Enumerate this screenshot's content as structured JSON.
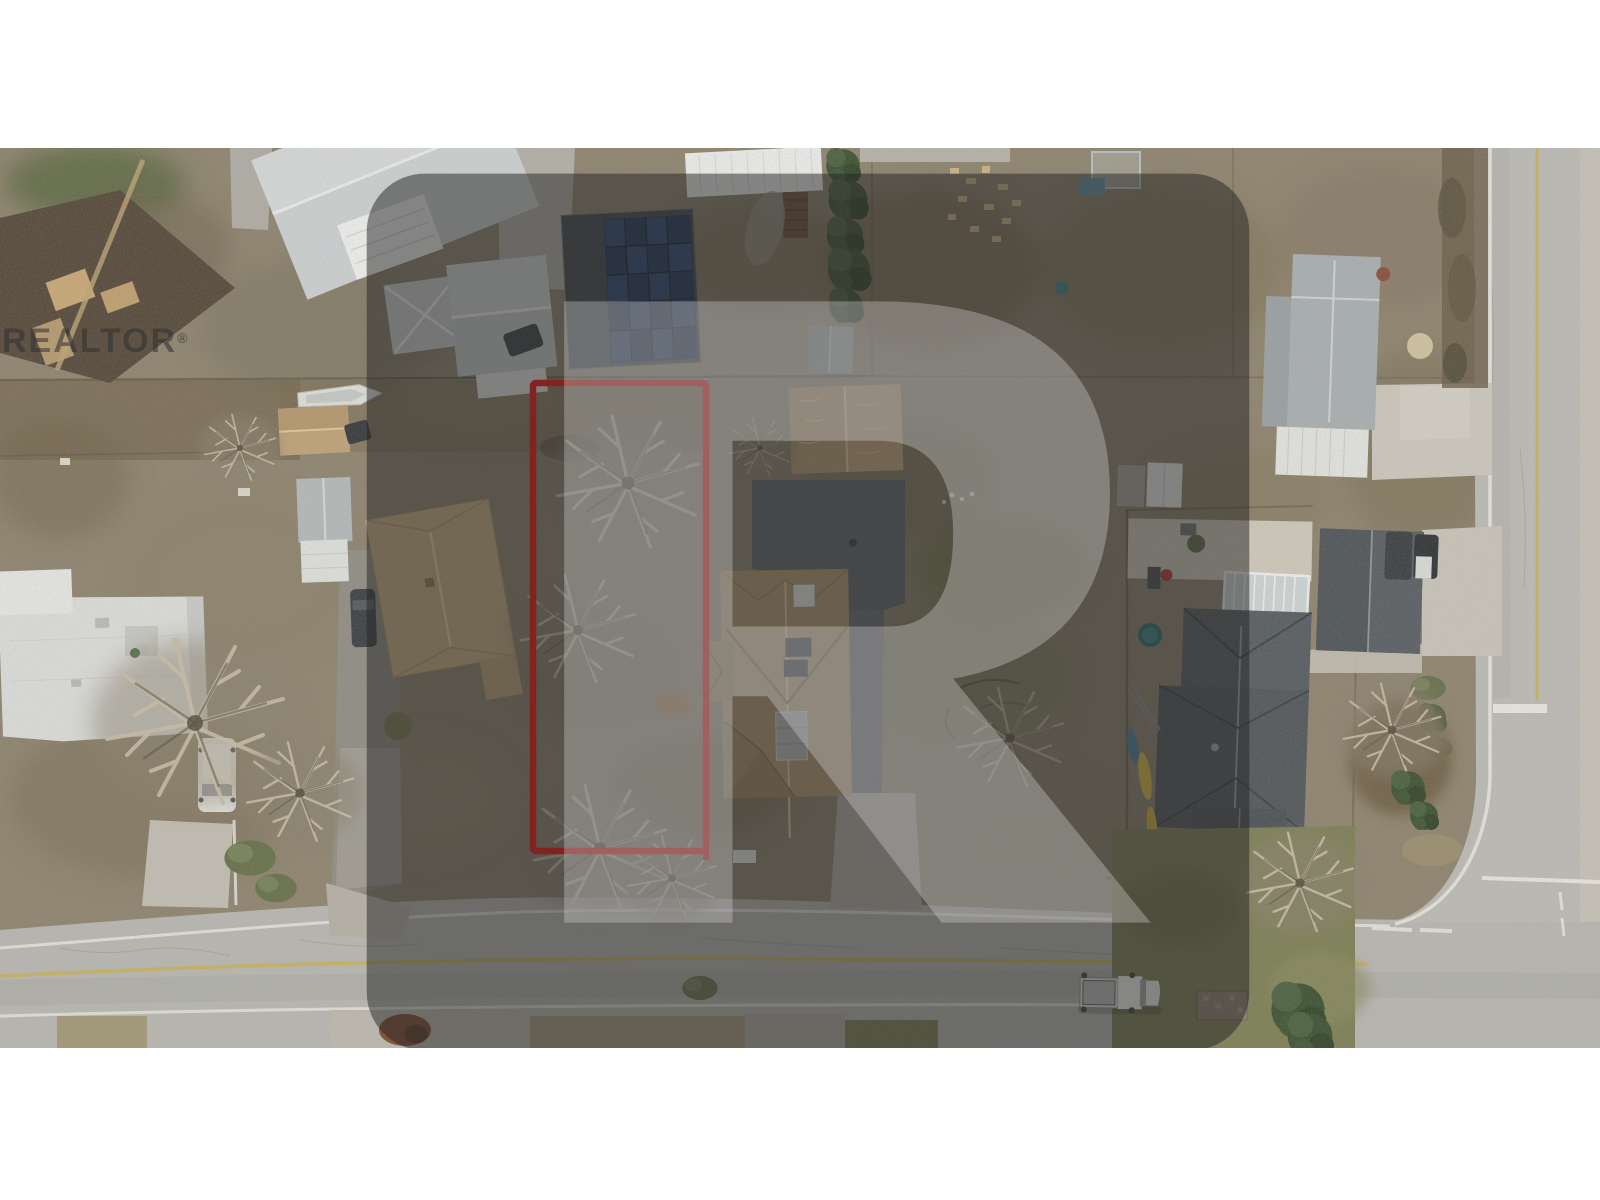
{
  "watermark": {
    "text": "REALTOR",
    "registered_symbol": "®",
    "logo_icon": "realtor-block-r-logo"
  },
  "boundary": {
    "outline_color": "#e0231f"
  },
  "palette": {
    "ground": "#8e8470",
    "road": "#b8b7b3",
    "centerline_yellow": "#c8b258"
  }
}
